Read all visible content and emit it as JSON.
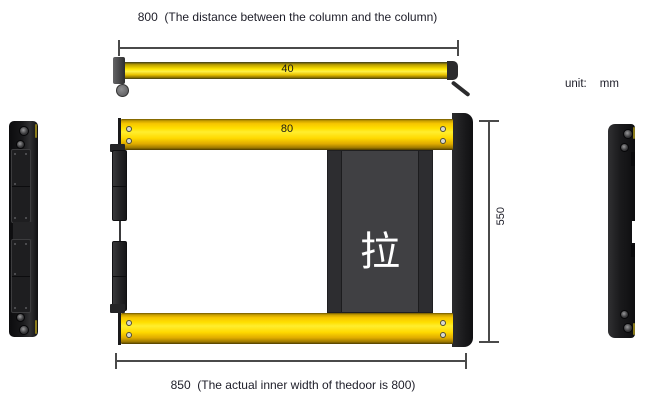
{
  "unit_note": {
    "label": "unit:",
    "value": "mm"
  },
  "top_view": {
    "dimension_text": "800  (The distance between the column and the column)",
    "bar_width_label": "40"
  },
  "front_view": {
    "rail_width_label": "80",
    "height_label": "550",
    "panel_glyph": "拉",
    "bottom_dimension_text": "850  (The actual inner width of thedoor is 800)"
  },
  "colors": {
    "rail_yellow": "#ffdf00",
    "rail_bright": "#ffee2e",
    "rail_dark": "#8a6d00",
    "steel_black": "#1a1a1c",
    "panel_gray": "#404043",
    "dim_line": "#4a4a4a",
    "text_dark": "#1d1d28",
    "glyph_white": "#ffffff"
  }
}
